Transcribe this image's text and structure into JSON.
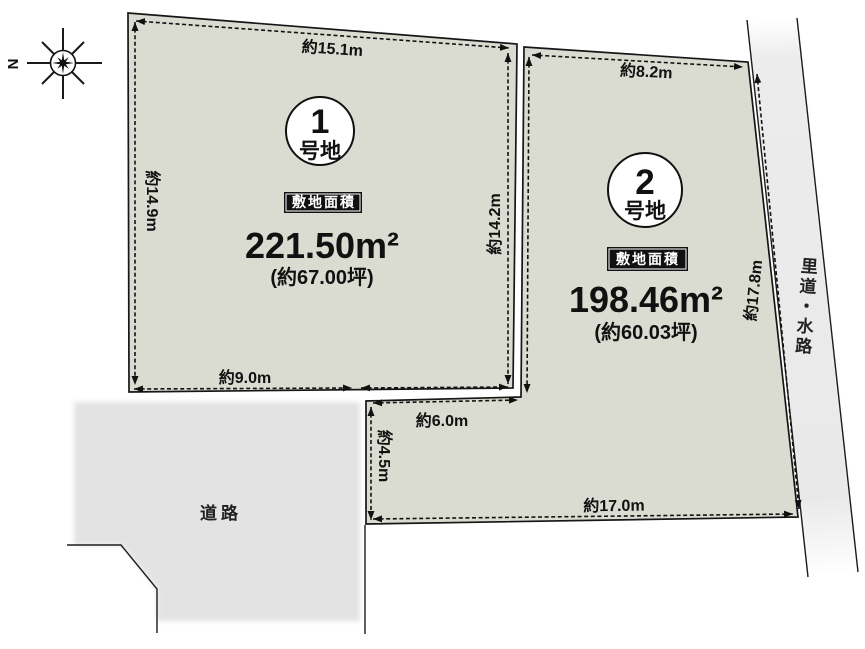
{
  "compass": {
    "north_label": "N"
  },
  "plots": [
    {
      "badge_number": "1",
      "badge_suffix": "号地",
      "area_label": "敷地面積",
      "area_value": "221.50",
      "area_unit": "m²",
      "area_tsubo": "(約67.00坪)",
      "dims": {
        "top": "約15.1m",
        "left": "約14.9m",
        "right": "約14.2m",
        "bottom": "約9.0m"
      }
    },
    {
      "badge_number": "2",
      "badge_suffix": "号地",
      "area_label": "敷地面積",
      "area_value": "198.46",
      "area_unit": "m²",
      "area_tsubo": "(約60.03坪)",
      "dims": {
        "top": "約8.2m",
        "right": "約17.8m",
        "bottom": "約17.0m",
        "left": "約4.5m",
        "step": "約6.0m"
      }
    }
  ],
  "labels": {
    "road": "道路",
    "waterway": "里道・水路"
  },
  "colors": {
    "plot_fill": "#dbdcd1",
    "road_fill": "#e3e3e3",
    "strip_fill": "#ececec",
    "line": "#161616"
  }
}
